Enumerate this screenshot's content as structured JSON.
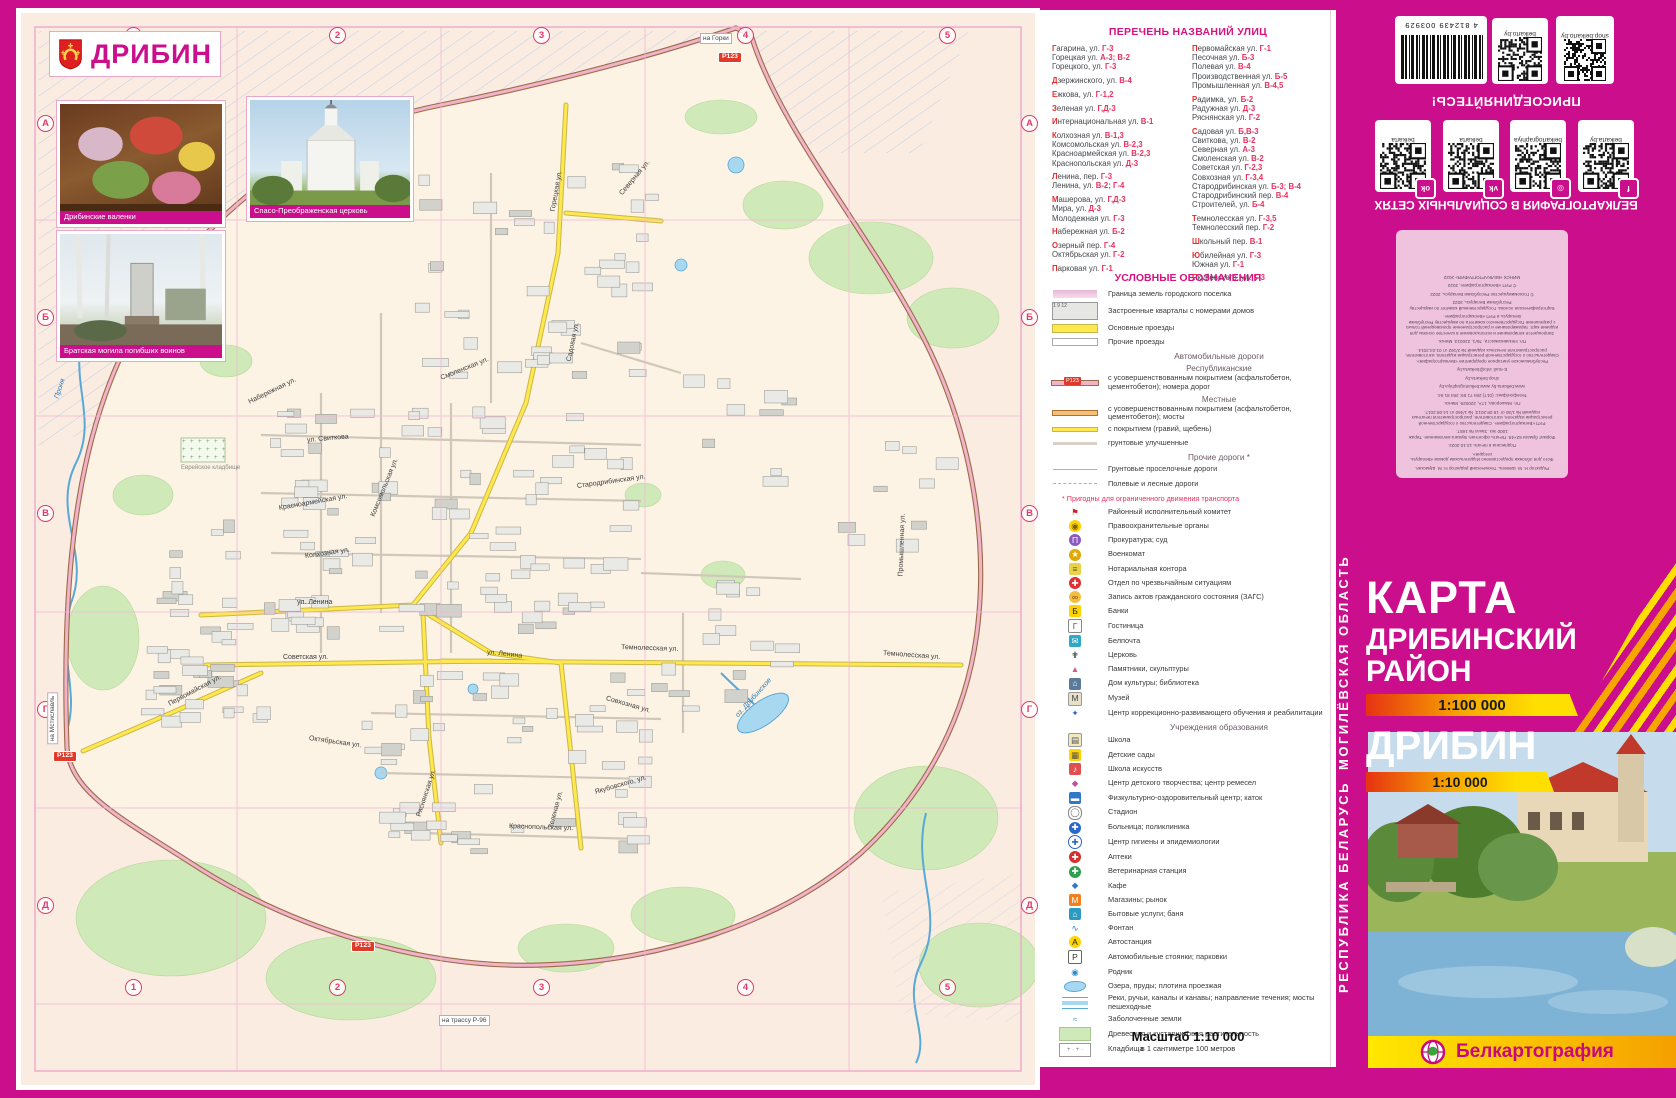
{
  "map": {
    "town_title": "ДРИБИН",
    "photos": [
      {
        "caption": "Дрибинские валенки"
      },
      {
        "caption": "Спасо-Преображенская церковь"
      },
      {
        "caption": "Братская могила погибших воинов"
      }
    ],
    "grid": {
      "cols": [
        "1",
        "2",
        "3",
        "4",
        "5"
      ],
      "rows": [
        "А",
        "Б",
        "В",
        "Г",
        "Д"
      ]
    },
    "road_badge": "Р123",
    "edge_labels": [
      {
        "t": "на Горки",
        "x": 679,
        "y": 20,
        "rot": 0
      },
      {
        "t": "на Мстиславль",
        "x": 6,
        "y": 700,
        "rot": -90
      },
      {
        "t": "на трассу Р-96",
        "x": 418,
        "y": 1002,
        "rot": 0
      }
    ],
    "badges": [
      {
        "x": 697,
        "y": 39
      },
      {
        "x": 32,
        "y": 738
      },
      {
        "x": 330,
        "y": 928
      }
    ],
    "street_labels": [
      {
        "t": "Горецкая ул.",
        "x": 532,
        "y": 195,
        "r": -80
      },
      {
        "t": "Северная ул.",
        "x": 600,
        "y": 178,
        "r": -50
      },
      {
        "t": "Садовая ул.",
        "x": 548,
        "y": 345,
        "r": -78
      },
      {
        "t": "ул. Свиткова",
        "x": 286,
        "y": 424,
        "r": -5
      },
      {
        "t": "Смоленская ул.",
        "x": 420,
        "y": 362,
        "r": -22
      },
      {
        "t": "Стародрибинская ул.",
        "x": 556,
        "y": 470,
        "r": -8
      },
      {
        "t": "Комсомольская ул.",
        "x": 352,
        "y": 500,
        "r": -68
      },
      {
        "t": "Красноармейская ул.",
        "x": 258,
        "y": 492,
        "r": -10
      },
      {
        "t": "Колхозная ул.",
        "x": 284,
        "y": 540,
        "r": -8
      },
      {
        "t": "ул. Ленина",
        "x": 276,
        "y": 586,
        "r": 0
      },
      {
        "t": "ул. Ленина",
        "x": 466,
        "y": 636,
        "r": 6
      },
      {
        "t": "Советская ул.",
        "x": 262,
        "y": 641,
        "r": 0
      },
      {
        "t": "Первомайская ул.",
        "x": 148,
        "y": 688,
        "r": -28
      },
      {
        "t": "Темнолесская ул.",
        "x": 600,
        "y": 631,
        "r": 2
      },
      {
        "t": "Темнолесская ул.",
        "x": 862,
        "y": 637,
        "r": 4
      },
      {
        "t": "Совхозная ул.",
        "x": 585,
        "y": 682,
        "r": 16
      },
      {
        "t": "Октябрьская ул.",
        "x": 288,
        "y": 722,
        "r": 8
      },
      {
        "t": "Ряснянская ул.",
        "x": 398,
        "y": 800,
        "r": -72
      },
      {
        "t": "Якубовского, ул.",
        "x": 574,
        "y": 776,
        "r": -16
      },
      {
        "t": "Краснопольская ул.",
        "x": 488,
        "y": 810,
        "r": 2
      },
      {
        "t": "Зеленая ул.",
        "x": 530,
        "y": 812,
        "r": -75
      },
      {
        "t": "Промышленная ул.",
        "x": 880,
        "y": 560,
        "r": -88
      },
      {
        "t": "Набережная ул.",
        "x": 228,
        "y": 386,
        "r": -26
      }
    ],
    "water_labels": [
      {
        "t": "Проня",
        "x": 36,
        "y": 382,
        "r": -72
      },
      {
        "t": "оз. Дрибинское",
        "x": 716,
        "y": 700,
        "r": -48
      }
    ],
    "area_labels": [
      {
        "t": "Еврейское кладбище",
        "x": 160,
        "y": 452,
        "r": 0
      }
    ]
  },
  "street_index": {
    "title": "ПЕРЕЧЕНЬ НАЗВАНИЙ УЛИЦ",
    "col1": [
      {
        "n": "Гагарина, ул. ",
        "r": "Г-3",
        "f": true
      },
      {
        "n": "Горецкая ул. ",
        "r": "А-3; В-2"
      },
      {
        "n": "Горецкого, ул. ",
        "r": "Г-3"
      },
      {
        "gap": true
      },
      {
        "n": "Дзержинского, ул. ",
        "r": "В-4",
        "f": true
      },
      {
        "gap": true
      },
      {
        "n": "Ежкова, ул. ",
        "r": "Г-1,2",
        "f": true
      },
      {
        "gap": true
      },
      {
        "n": "Зеленая ул. ",
        "r": "Г,Д-3",
        "f": true
      },
      {
        "gap": true
      },
      {
        "n": "Интернациональная ул. ",
        "r": "В-1",
        "f": true
      },
      {
        "gap": true
      },
      {
        "n": "Колхозная ул. ",
        "r": "В-1,3",
        "f": true
      },
      {
        "n": "Комсомольская ул. ",
        "r": "В-2,3"
      },
      {
        "n": "Красноармейская ул. ",
        "r": "В-2,3"
      },
      {
        "n": "Краснопольская ул. ",
        "r": "Д-3"
      },
      {
        "gap": true
      },
      {
        "n": "Ленина, пер. ",
        "r": "Г-3",
        "f": true
      },
      {
        "n": "Ленина, ул. ",
        "r": "В-2; Г-4"
      },
      {
        "gap": true
      },
      {
        "n": "Машерова, ул. ",
        "r": "Г,Д-3",
        "f": true
      },
      {
        "n": "Мира, ул. ",
        "r": "Д-3"
      },
      {
        "n": "Молодежная ул. ",
        "r": "Г-3"
      },
      {
        "gap": true
      },
      {
        "n": "Набережная ул. ",
        "r": "Б-2",
        "f": true
      },
      {
        "gap": true
      },
      {
        "n": "Озерный пер. ",
        "r": "Г-4",
        "f": true
      },
      {
        "n": "Октябрьская ул. ",
        "r": "Г-2"
      },
      {
        "gap": true
      },
      {
        "n": "Парковая ул. ",
        "r": "Г-1",
        "f": true
      }
    ],
    "col2": [
      {
        "n": "Первомайская ул. ",
        "r": "Г-1",
        "f": true
      },
      {
        "n": "Песочная ул. ",
        "r": "Б-3"
      },
      {
        "n": "Полевая ул. ",
        "r": "В-4"
      },
      {
        "n": "Производственная ул. ",
        "r": "Б-5"
      },
      {
        "n": "Промышленная ул. ",
        "r": "В-4,5"
      },
      {
        "gap": true
      },
      {
        "n": "Радимка, ул. ",
        "r": "Б-2",
        "f": true
      },
      {
        "n": "Радужная ул. ",
        "r": "Д-3"
      },
      {
        "n": "Ряснянская ул. ",
        "r": "Г-2"
      },
      {
        "gap": true
      },
      {
        "n": "Садовая ул. ",
        "r": "Б,В-3",
        "f": true
      },
      {
        "n": "Свиткова, ул. ",
        "r": "В-2"
      },
      {
        "n": "Северная ул. ",
        "r": "А-3"
      },
      {
        "n": "Смоленская ул. ",
        "r": "В-2"
      },
      {
        "n": "Советская ул. ",
        "r": "Г-2,3"
      },
      {
        "n": "Совхозная ул. ",
        "r": "Г-3,4"
      },
      {
        "n": "Стародрибинская ул. ",
        "r": "Б-3; В-4"
      },
      {
        "n": "Стародрибинский пер. ",
        "r": "В-4"
      },
      {
        "n": "Строителей, ул. ",
        "r": "Б-4"
      },
      {
        "gap": true
      },
      {
        "n": "Темнолесская ул. ",
        "r": "Г-3,5",
        "f": true
      },
      {
        "n": "Темнолесский пер. ",
        "r": "Г-2"
      },
      {
        "gap": true
      },
      {
        "n": "Школьный пер. ",
        "r": "В-1",
        "f": true
      },
      {
        "gap": true
      },
      {
        "n": "Юбилейная ул. ",
        "r": "Г-3",
        "f": true
      },
      {
        "n": "Южная ул. ",
        "r": "Г-1"
      },
      {
        "gap": true
      },
      {
        "n": "Якубовского, ул. ",
        "r": "Г-3",
        "f": true
      }
    ]
  },
  "legend": {
    "title": "УСЛОВНЫЕ ОБОЗНАЧЕНИЯ",
    "rows": [
      {
        "sw": "border",
        "t": "Граница земель городского поселка"
      },
      {
        "sw": "blocks",
        "t": "Застроенные кварталы с номерами домов"
      },
      {
        "sw": "mainpass",
        "t": "Основные проезды"
      },
      {
        "sw": "otherpass",
        "t": "Прочие проезды"
      },
      {
        "h": "Автомобильные дороги"
      },
      {
        "h": "Республиканские"
      },
      {
        "sw": "rep",
        "t": "с усовершенствованным покрытием (асфальтобетон, цементобетон); номера дорог"
      },
      {
        "h": "Местные"
      },
      {
        "sw": "loc",
        "t": "с усовершенствованным покрытием (асфальтобетон, цементобетон); мосты"
      },
      {
        "sw": "gravel",
        "t": "с покрытием (гравий, щебень)"
      },
      {
        "sw": "dirt",
        "t": "грунтовые улучшенные"
      },
      {
        "h": "Прочие дороги *"
      },
      {
        "sw": "country",
        "t": "Грунтовые проселочные дороги"
      },
      {
        "sw": "field",
        "t": "Полевые и лесные дороги"
      },
      {
        "note": "* Пригодны для ограниченного движения транспорта"
      },
      {
        "ic": "flag",
        "t": "Районный исполнительный комитет"
      },
      {
        "ic": "shield",
        "t": "Правоохранительные органы"
      },
      {
        "ic": "prosecutor",
        "t": "Прокуратура; суд"
      },
      {
        "ic": "star",
        "t": "Военкомат"
      },
      {
        "ic": "notary",
        "t": "Нотариальная контора"
      },
      {
        "ic": "mchs",
        "t": "Отдел по чрезвычайным ситуациям"
      },
      {
        "ic": "zags",
        "t": "Запись актов гражданского состояния (ЗАГС)"
      },
      {
        "ic": "bank",
        "t": "Банки"
      },
      {
        "ic": "hotel",
        "t": "Гостиница"
      },
      {
        "ic": "post",
        "t": "Белпочта"
      },
      {
        "ic": "church",
        "t": "Церковь"
      },
      {
        "ic": "monument",
        "t": "Памятники, скульптуры"
      },
      {
        "ic": "culture",
        "t": "Дом культуры; библиотека"
      },
      {
        "ic": "museum",
        "t": "Музей"
      },
      {
        "ic": "correction",
        "t": "Центр коррекционно-развивающего обучения и реабилитации"
      },
      {
        "h": "Учреждения образования"
      },
      {
        "ic": "school",
        "t": "Школа"
      },
      {
        "ic": "kindergarten",
        "t": "Детские сады"
      },
      {
        "ic": "artschool",
        "t": "Школа искусств"
      },
      {
        "ic": "creativity",
        "t": "Центр детского творчества; центр ремесел"
      },
      {
        "ic": "sport",
        "t": "Физкультурно-оздоровительный центр; каток"
      },
      {
        "ic": "stadium",
        "t": "Стадион"
      },
      {
        "ic": "hospital",
        "t": "Больница; поликлиника"
      },
      {
        "ic": "hygiene",
        "t": "Центр гигиены и эпидемиологии"
      },
      {
        "ic": "pharmacy",
        "t": "Аптеки"
      },
      {
        "ic": "vet",
        "t": "Ветеринарная станция"
      },
      {
        "ic": "cafe",
        "t": "Кафе"
      },
      {
        "ic": "shop",
        "t": "Магазины; рынок"
      },
      {
        "ic": "services",
        "t": "Бытовые услуги; баня"
      },
      {
        "ic": "fountain",
        "t": "Фонтан"
      },
      {
        "ic": "busstation",
        "t": "Автостанция"
      },
      {
        "ic": "parking",
        "t": "Автомобильные стоянки; парковки"
      },
      {
        "ic": "spring",
        "t": "Родник"
      },
      {
        "ic": "lake",
        "t": "Озера, пруды; плотина проезжая"
      },
      {
        "ic": "river",
        "t": "Реки, ручьи, каналы и канавы; направление течения; мосты пешеходные"
      },
      {
        "ic": "marsh",
        "t": "Заболоченные земли"
      },
      {
        "ic": "forest",
        "t": "Древесная и кустарниковая растительность"
      },
      {
        "ic": "cemetery",
        "t": "Кладбища"
      }
    ],
    "scale_title": "Масштаб 1:10 000",
    "scale_sub": "в 1 сантиметре 100 метров"
  },
  "back_cover": {
    "barcode_number": "4 812439 003929",
    "qr_top": [
      {
        "label": "belkarto.by"
      },
      {
        "label": "shop.belkarto.by"
      }
    ],
    "join_heading": "ПРИСОЕДИНЯЙТЕСЬ!",
    "social_qrs": [
      {
        "label": "belkarta",
        "icon": "ok"
      },
      {
        "label": "belkarta",
        "icon": "vk"
      },
      {
        "label": "belkartographiya",
        "icon": "instagram"
      },
      {
        "label": "belkarta.by",
        "icon": "facebook"
      }
    ],
    "social_heading": "БЕЛКАРТОГРАФИЯ В СОЦИАЛЬНЫХ СЕТЯХ",
    "imprint_lines": [
      "Редактор Н. М. Шевель. Технический редактор Н. М. Шумская.",
      "Фото для обложки предоставлено Издательским домом «Беларусь сегодня».",
      "Подписана в печать 13.10.2022.",
      "Формат бумаги 62×48. Печать офсетная. Бумага мелованная. Тираж 1000 экз. Заказ № 1657.",
      "РУП «Белкартография». Свидетельство о государственной регистрации издателя, изготовителя, распространителя печатных изданий № 1/30 от 18.08.2013; № 1/460 от 14.08.2017.",
      "Пл. Машерова, 17А, 220029, Минск.",
      "Телефон/факс: (017) 284 71 59; 284 81 54.",
      "www.belkarta.by   www.belkartographiya.by",
      "shop.belkarta.by",
      "E-mail: info@belkarta.by",
      "Республиканское унитарное предприятие «Белкартография». Свидетельство о государственной регистрации издателя, изготовителя, распространителя печатных изданий № 2/192 от 01.04.2014.",
      "Пл. Независимости, 7Б/1, 220013, Минск.",
      "Запрещается копирование и использование в качестве основы для издания карт, тиражирование и распространение произведений только с разрешения Государственного комитета по имуществу Республики Беларусь и РУП «Белкартография».",
      "Картографическая основа. Государственный комитет по имуществу Республики Беларусь, 2022",
      "© Госкомимущество Республики Беларусь, 2022",
      "© РУП «Белкартография», 2022",
      "МИНСК «БЕЛКАРТОГРАФИЯ» 2022"
    ]
  },
  "cover": {
    "region_vertical": "МОГИЛЁВСКАЯ ОБЛАСТЬ",
    "country_vertical": "РЕСПУБЛИКА БЕЛАРУСЬ",
    "title": "КАРТА",
    "subtitle_line1": "ДРИБИНСКИЙ",
    "subtitle_line2": "РАЙОН",
    "scale1": "1:100 000",
    "town": "ДРИБИН",
    "scale2": "1:10 000",
    "publisher": "Белкартография"
  },
  "colors": {
    "magenta": "#cb0e8c",
    "map_bg": "#fbece2",
    "map_inner": "#fdf3e4",
    "road_yellow": "#ffe84d",
    "ring_pink": "#f0b3c8",
    "ring_casing": "#9c6b4a",
    "green": "#cfe9b8",
    "water": "#a8d8f0",
    "index_ref": "#e8315f"
  }
}
